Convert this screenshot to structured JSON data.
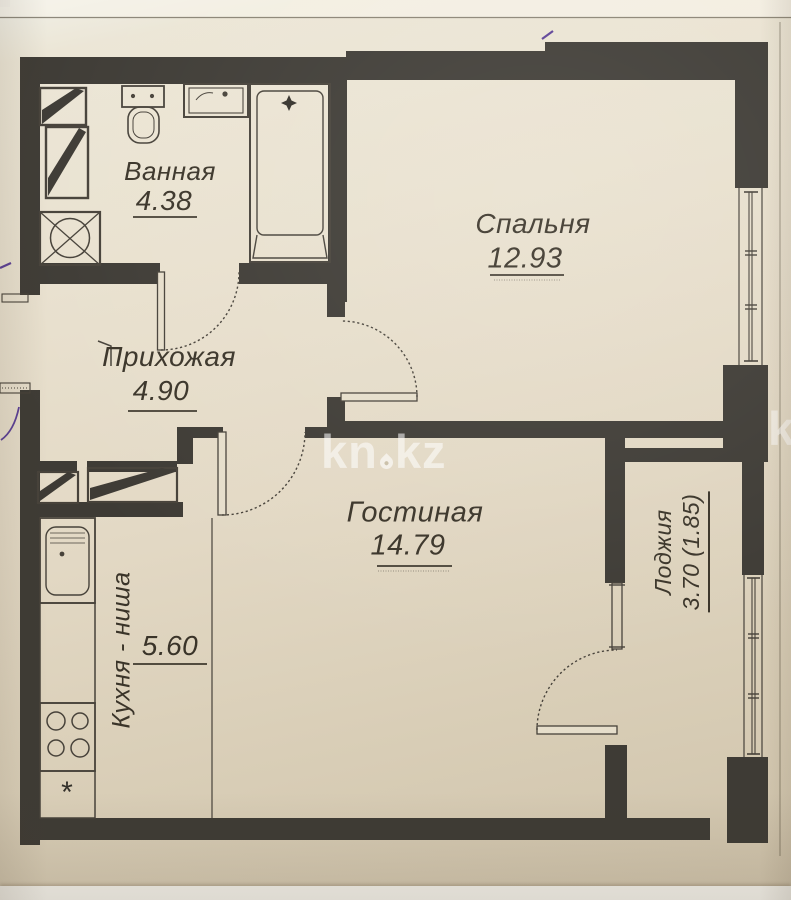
{
  "watermark": {
    "left": "kn",
    "right": "kz",
    "full": "kn.kz",
    "partial_right_edge": "k"
  },
  "rooms": {
    "bathroom": {
      "label": "Ванная",
      "area": "4.38"
    },
    "bedroom": {
      "label": "Спальня",
      "area": "12.93"
    },
    "hallway": {
      "label": "Прихожая",
      "area": "4.90"
    },
    "living_room": {
      "label": "Гостиная",
      "area": "14.79"
    },
    "kitchen_niche": {
      "label": "Кухня - ниша",
      "area": "5.60"
    },
    "loggia": {
      "label": "Лоджия",
      "area": "3.70 (1.85)"
    }
  },
  "symbols": {
    "kitchen_note": "*"
  },
  "fixtures": [
    "bathtub",
    "toilet",
    "wash-basin",
    "washing-machine",
    "ventilation-shaft",
    "wardrobe",
    "kitchen-sink",
    "stove-4-burner",
    "entry-threshold",
    "windows",
    "door-swings"
  ],
  "colors": {
    "wall": "#3e3b35",
    "line": "#47423a",
    "paper": "#e7dfcd",
    "ink_accent": "#5c4096",
    "watermark_white": "rgba(255,255,255,0.55)"
  }
}
